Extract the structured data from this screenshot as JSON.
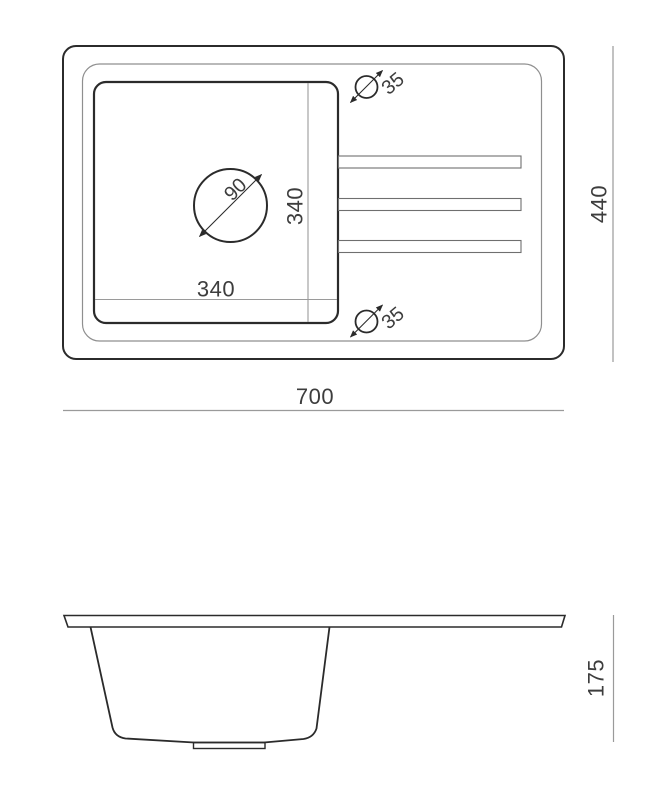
{
  "title": "Kitchen sink technical drawing, top view and side section view",
  "colors": {
    "background": "#ffffff",
    "line_dark": "#2b2b2b",
    "line_medium": "#6f6f6f",
    "line_light": "#9a9a9a",
    "text": "#3d3d3d"
  },
  "top_view": {
    "overall_width_mm": "700",
    "overall_depth_mm": "440",
    "bowl_width_mm": "340",
    "bowl_depth_mm": "340",
    "drain_diameter_mm": "90",
    "tap_hole_top_diameter_mm": "35",
    "tap_hole_bottom_diameter_mm": "35"
  },
  "side_view": {
    "bowl_depth_mm": "175"
  }
}
